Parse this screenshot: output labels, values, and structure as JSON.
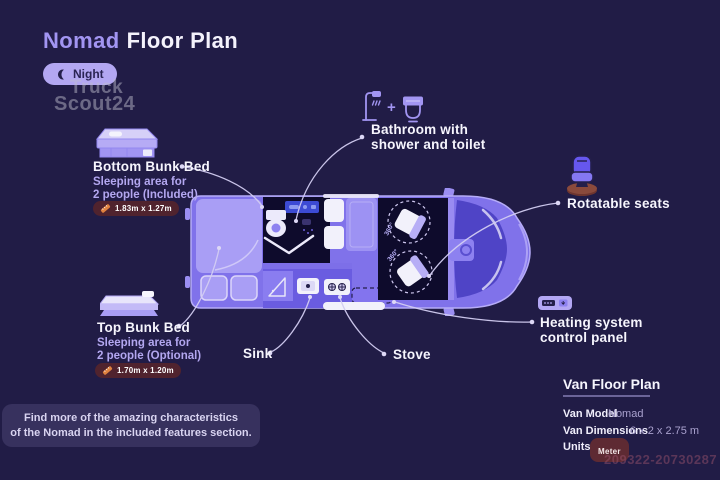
{
  "header": {
    "title_accent": "Nomad",
    "title_rest": "Floor Plan",
    "night_toggle": "Night"
  },
  "watermark": {
    "line1": "Truck",
    "line2": "Scout24",
    "listing_id": "209322-20730287"
  },
  "callouts": {
    "bottom_bunk": {
      "title": "Bottom Bunk Bed",
      "desc_line1": "Sleeping area for",
      "desc_line2": "2 people (Included)",
      "dimensions": "1.83m x 1.27m"
    },
    "top_bunk": {
      "title": "Top Bunk Bed",
      "desc_line1": "Sleeping area for",
      "desc_line2": "2 people (Optional)",
      "dimensions": "1.70m x 1.20m"
    },
    "bathroom": {
      "line1": "Bathroom with",
      "line2": "shower and toilet",
      "plus": "+"
    },
    "rotatable_seats": {
      "label": "Rotatable seats"
    },
    "heating": {
      "line1": "Heating system",
      "line2": "control panel"
    },
    "sink": {
      "label": "Sink"
    },
    "stove": {
      "label": "Stove"
    }
  },
  "floorplan": {
    "rotation_badge": "360°"
  },
  "note": {
    "line1": "Find more of the amazing characteristics",
    "line2": "of the Nomad in the included features section."
  },
  "info_panel": {
    "title": "Van Floor Plan",
    "model_label": "Van Model",
    "model_value": "Nomad",
    "dimensions_label": "Van Dimensions",
    "dimensions_value": "6 x 2 x 2.75 m",
    "units_label": "Units",
    "units_value": "Meter"
  },
  "colors": {
    "background": "#211c46",
    "accent_purple": "#a295f2",
    "light_purple": "#b3a7f2",
    "van_body": "#8072ea",
    "van_dark_interior": "#0e0b2c",
    "badge_maroon": "#50232e",
    "leader_line": "#d3cdf2",
    "white": "#f6f5fd"
  }
}
